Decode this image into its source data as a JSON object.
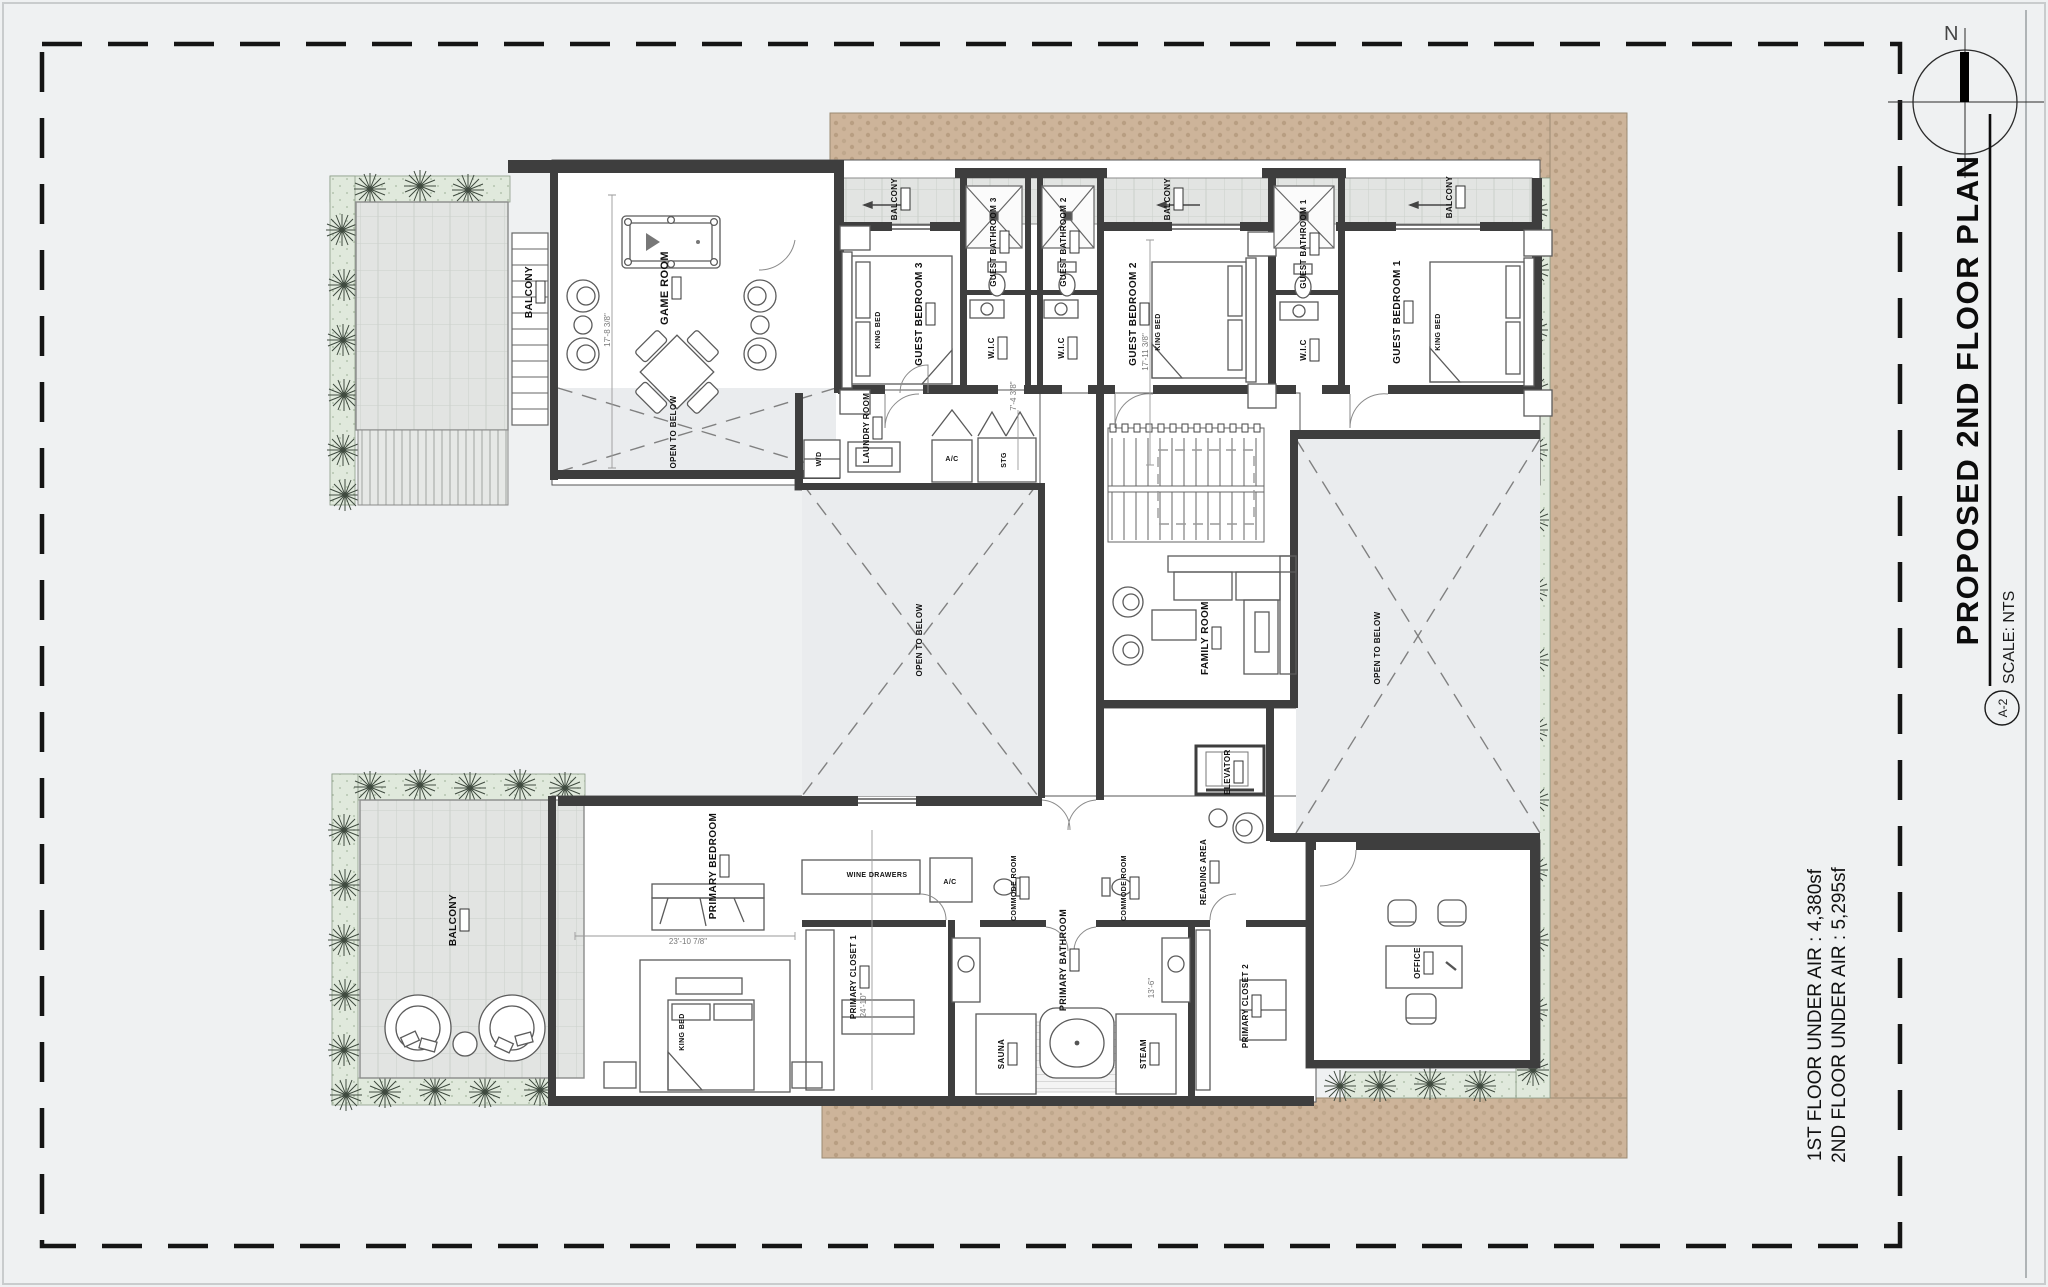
{
  "title_block": {
    "title": "PROPOSED 2ND FLOOR PLAN",
    "sheet_number": "A-2",
    "scale": "SCALE: NTS"
  },
  "compass": {
    "north_label": "N"
  },
  "area_notes": {
    "line1": "1ST FLOOR UNDER AIR :  4,380sf",
    "line2": "2ND FLOOR UNDER AIR :  5,295sf"
  },
  "colors": {
    "paper": "#eff1f2",
    "paver": "#cdb49a",
    "paver_dot": "#b89e82",
    "planting": "#e0e9dc",
    "balcony_tile": "#e2e4e2",
    "wall": "#3e3e3e",
    "open_below_fill": "#eaecee"
  },
  "plan": {
    "labels": [
      {
        "name": "label-balcony-top-left",
        "text": "BALCONY",
        "x": 532,
        "y": 292,
        "s": 10,
        "rot": 1,
        "tag": 1
      },
      {
        "name": "label-game-room",
        "text": "GAME ROOM",
        "x": 668,
        "y": 288,
        "s": 11,
        "rot": 1,
        "tag": 1
      },
      {
        "name": "label-open-to-below-left",
        "text": "OPEN TO BELOW",
        "x": 676,
        "y": 432,
        "s": 8,
        "rot": 1,
        "tag": 0
      },
      {
        "name": "label-guest-bedroom-3",
        "text": "GUEST BEDROOM 3",
        "x": 922,
        "y": 314,
        "s": 10,
        "rot": 1,
        "tag": 1
      },
      {
        "name": "label-king-bed-3",
        "text": "KING BED",
        "x": 880,
        "y": 330,
        "s": 7,
        "rot": 1,
        "tag": 0
      },
      {
        "name": "label-guest-bathroom-3",
        "text": "GUEST BATHROOM 3",
        "x": 996,
        "y": 242,
        "s": 8,
        "rot": 1,
        "tag": 1
      },
      {
        "name": "label-wic-3",
        "text": "W.I.C",
        "x": 994,
        "y": 348,
        "s": 8,
        "rot": 1,
        "tag": 1
      },
      {
        "name": "label-guest-bathroom-2",
        "text": "GUEST BATHROOM 2",
        "x": 1066,
        "y": 242,
        "s": 8,
        "rot": 1,
        "tag": 1
      },
      {
        "name": "label-wic-2",
        "text": "W.I.C",
        "x": 1064,
        "y": 348,
        "s": 8,
        "rot": 1,
        "tag": 1
      },
      {
        "name": "label-balcony-bed3",
        "text": "BALCONY",
        "x": 897,
        "y": 199,
        "s": 8,
        "rot": 1,
        "tag": 1
      },
      {
        "name": "label-balcony-bed2",
        "text": "BALCONY",
        "x": 1170,
        "y": 199,
        "s": 8,
        "rot": 1,
        "tag": 1
      },
      {
        "name": "label-balcony-bed1",
        "text": "BALCONY",
        "x": 1452,
        "y": 197,
        "s": 8,
        "rot": 1,
        "tag": 1
      },
      {
        "name": "label-guest-bedroom-2",
        "text": "GUEST BEDROOM 2",
        "x": 1136,
        "y": 314,
        "s": 10,
        "rot": 1,
        "tag": 1
      },
      {
        "name": "label-king-bed-2",
        "text": "KING BED",
        "x": 1160,
        "y": 332,
        "s": 7,
        "rot": 1,
        "tag": 0
      },
      {
        "name": "label-guest-bathroom-1",
        "text": "GUEST BATHROOM 1",
        "x": 1306,
        "y": 244,
        "s": 8,
        "rot": 1,
        "tag": 1
      },
      {
        "name": "label-wic-1",
        "text": "W.I.C",
        "x": 1306,
        "y": 350,
        "s": 8,
        "rot": 1,
        "tag": 1
      },
      {
        "name": "label-guest-bedroom-1",
        "text": "GUEST BEDROOM 1",
        "x": 1400,
        "y": 312,
        "s": 10,
        "rot": 1,
        "tag": 1
      },
      {
        "name": "label-king-bed-1",
        "text": "KING BED",
        "x": 1440,
        "y": 332,
        "s": 7,
        "rot": 1,
        "tag": 0
      },
      {
        "name": "label-laundry-room",
        "text": "LAUNDRY ROOM",
        "x": 869,
        "y": 428,
        "s": 8,
        "rot": 1,
        "tag": 1
      },
      {
        "name": "label-washer-dryer",
        "text": "W/D",
        "x": 821,
        "y": 459,
        "s": 7,
        "rot": 1,
        "tag": 0
      },
      {
        "name": "label-ac-closet-1",
        "text": "A/C",
        "x": 952,
        "y": 461,
        "s": 7,
        "rot": 0,
        "tag": 0
      },
      {
        "name": "label-storage",
        "text": "STG",
        "x": 1006,
        "y": 460,
        "s": 7,
        "rot": 1,
        "tag": 0
      },
      {
        "name": "label-open-to-below-center",
        "text": "OPEN TO BELOW",
        "x": 922,
        "y": 640,
        "s": 8,
        "rot": 1,
        "tag": 0
      },
      {
        "name": "label-family-room",
        "text": "FAMILY ROOM",
        "x": 1208,
        "y": 638,
        "s": 10,
        "rot": 1,
        "tag": 1
      },
      {
        "name": "label-open-to-below-right",
        "text": "OPEN TO BELOW",
        "x": 1380,
        "y": 648,
        "s": 8,
        "rot": 1,
        "tag": 0
      },
      {
        "name": "label-elevator",
        "text": "ELEVATOR",
        "x": 1230,
        "y": 772,
        "s": 8,
        "rot": 1,
        "tag": 1
      },
      {
        "name": "label-reading-area",
        "text": "READING AREA",
        "x": 1206,
        "y": 872,
        "s": 8,
        "rot": 1,
        "tag": 1
      },
      {
        "name": "label-balcony-bottom-left",
        "text": "BALCONY",
        "x": 456,
        "y": 920,
        "s": 10,
        "rot": 1,
        "tag": 1
      },
      {
        "name": "label-primary-bedroom",
        "text": "PRIMARY BEDROOM",
        "x": 716,
        "y": 866,
        "s": 10,
        "rot": 1,
        "tag": 1
      },
      {
        "name": "label-king-bed-primary",
        "text": "KING BED",
        "x": 684,
        "y": 1032,
        "s": 7,
        "rot": 1,
        "tag": 0
      },
      {
        "name": "label-wine-drawers",
        "text": "WINE DRAWERS",
        "x": 877,
        "y": 877,
        "s": 7,
        "rot": 0,
        "tag": 0
      },
      {
        "name": "label-ac-closet-2",
        "text": "A/C",
        "x": 950,
        "y": 884,
        "s": 7,
        "rot": 0,
        "tag": 0
      },
      {
        "name": "label-commode-room-1",
        "text": "COMMODE ROOM",
        "x": 1016,
        "y": 888,
        "s": 7,
        "rot": 1,
        "tag": 1
      },
      {
        "name": "label-commode-room-2",
        "text": "COMMODE ROOM",
        "x": 1126,
        "y": 888,
        "s": 7,
        "rot": 1,
        "tag": 1
      },
      {
        "name": "label-primary-bathroom",
        "text": "PRIMARY BATHROOM",
        "x": 1066,
        "y": 960,
        "s": 9,
        "rot": 1,
        "tag": 1
      },
      {
        "name": "label-primary-closet-1",
        "text": "PRIMARY CLOSET 1",
        "x": 856,
        "y": 977,
        "s": 8,
        "rot": 1,
        "tag": 1
      },
      {
        "name": "label-sauna",
        "text": "SAUNA",
        "x": 1004,
        "y": 1054,
        "s": 8,
        "rot": 1,
        "tag": 1
      },
      {
        "name": "label-steam",
        "text": "STEAM",
        "x": 1146,
        "y": 1054,
        "s": 8,
        "rot": 1,
        "tag": 1
      },
      {
        "name": "label-primary-closet-2",
        "text": "PRIMARY CLOSET 2",
        "x": 1248,
        "y": 1006,
        "s": 8,
        "rot": 1,
        "tag": 1
      },
      {
        "name": "label-office",
        "text": "OFFICE",
        "x": 1420,
        "y": 963,
        "s": 8,
        "rot": 1,
        "tag": 1
      }
    ],
    "dims": [
      {
        "name": "dim-game-room",
        "text": "17'-8 3/8\"",
        "x": 610,
        "y": 330,
        "rot": 1
      },
      {
        "name": "dim-guest-bedroom",
        "text": "17'-11 3/8\"",
        "x": 1148,
        "y": 352,
        "rot": 1
      },
      {
        "name": "dim-primary-width",
        "text": "23'-10 7/8\"",
        "x": 688,
        "y": 944,
        "rot": 0
      },
      {
        "name": "dim-primary-height",
        "text": "24'-10\"",
        "x": 866,
        "y": 1005,
        "rot": 1
      },
      {
        "name": "dim-primary-bath",
        "text": "13'-6\"",
        "x": 1154,
        "y": 988,
        "rot": 1
      },
      {
        "name": "dim-wic",
        "text": "7'-4 3/8\"",
        "x": 1016,
        "y": 396,
        "rot": 1
      }
    ]
  }
}
